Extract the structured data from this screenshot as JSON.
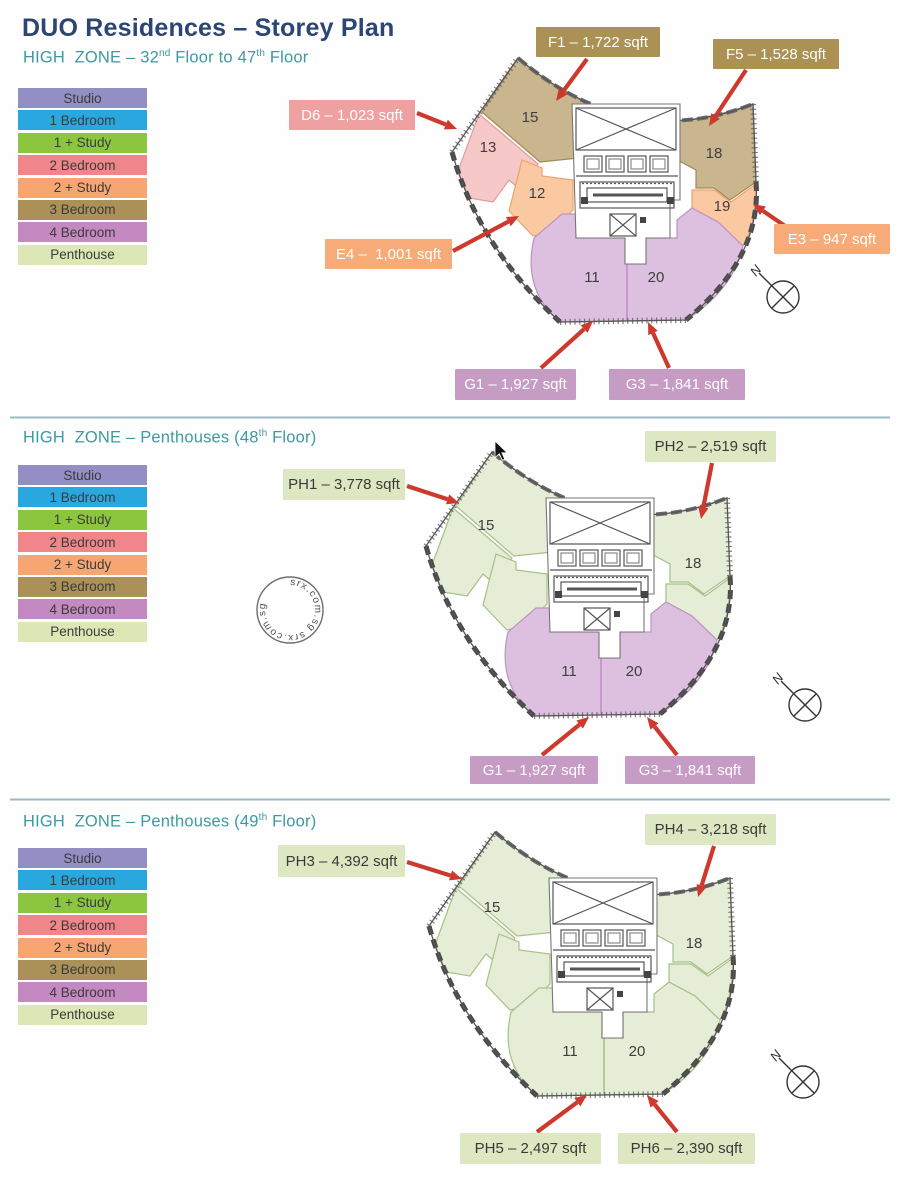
{
  "title": "DUO Residences – Storey Plan",
  "watermark_text": "srx.com.sg",
  "compass_label": "N",
  "legend": {
    "items": [
      {
        "key": "studio",
        "label": "Studio"
      },
      {
        "key": "bed1",
        "label": "1 Bedroom"
      },
      {
        "key": "bed1study",
        "label": "1 + Study"
      },
      {
        "key": "bed2",
        "label": "2 Bedroom"
      },
      {
        "key": "bed2study",
        "label": "2 + Study"
      },
      {
        "key": "bed3",
        "label": "3 Bedroom"
      },
      {
        "key": "bed4",
        "label": "4 Bedroom"
      },
      {
        "key": "penthouse",
        "label": "Penthouse"
      }
    ]
  },
  "colors": {
    "title": "#2c4573",
    "subtitle": "#3d9aa1",
    "arrow": "#ce382d",
    "separator": "#9db9c6",
    "plan_line": "#565656",
    "legend": {
      "studio": "#938fc5",
      "bed1": "#29a8e0",
      "bed1study": "#8cc63f",
      "bed2": "#f0868a",
      "bed2study": "#f8a671",
      "bed3": "#ab9157",
      "bed4": "#c489c0",
      "penthouse": "#dde7b6"
    },
    "region_fill": {
      "bed2": "#f7c8c8",
      "bed2study": "#fac9a2",
      "bed3": "#c9b58e",
      "bed4": "#ddbfdf",
      "penthouse": "#e5edd6"
    },
    "region_stroke": {
      "bed2": "#e39b9b",
      "bed2study": "#eca26e",
      "bed3": "#a18a56",
      "bed4": "#c092c2",
      "penthouse": "#a9bf86"
    },
    "callout": {
      "tan": "#ab9254",
      "pink": "#efa1a1",
      "orange": "#f6ab79",
      "purple": "#c79cc4",
      "green": "#dde8c2"
    },
    "callout_text": {
      "tan": "#ffffff",
      "pink": "#ffffff",
      "orange": "#ffffff",
      "purple": "#ffffff",
      "green": "#3a3a3a"
    }
  },
  "sections": [
    {
      "subtitle": {
        "part1": "HIGH  ZONE – 32",
        "sup1": "nd",
        "part2": " Floor to 47",
        "sup2": "th",
        "part3": " Floor"
      },
      "units": {
        "u15": "15",
        "u13": "13",
        "u12": "12",
        "u18": "18",
        "u19": "19",
        "u11": "11",
        "u20": "20"
      },
      "region_types": {
        "r15": "bed3",
        "r13": "bed2",
        "r12": "bed2study",
        "r18": "bed3",
        "r19": "bed2study",
        "r11_20": "bed4"
      },
      "callouts": [
        {
          "id": "F1",
          "label": "F1 – 1,722 sqft",
          "color": "tan"
        },
        {
          "id": "F5",
          "label": "F5 – 1,528 sqft",
          "color": "tan"
        },
        {
          "id": "D6",
          "label": "D6 – 1,023 sqft",
          "color": "pink"
        },
        {
          "id": "E4",
          "label": "E4 –  1,001 sqft",
          "color": "orange"
        },
        {
          "id": "E3",
          "label": "E3 – 947 sqft",
          "color": "orange"
        },
        {
          "id": "G1",
          "label": "G1 – 1,927 sqft",
          "color": "purple"
        },
        {
          "id": "G3",
          "label": "G3 – 1,841 sqft",
          "color": "purple"
        }
      ]
    },
    {
      "subtitle": {
        "part1": "HIGH  ZONE – Penthouses (48",
        "sup1": "th",
        "part2": " Floor)",
        "sup2": "",
        "part3": ""
      },
      "units": {
        "u15": "15",
        "u18": "18",
        "u11": "11",
        "u20": "20"
      },
      "region_types": {
        "r15": "penthouse",
        "r13": "penthouse",
        "r12": "penthouse",
        "r18": "penthouse",
        "r19": "penthouse",
        "r11_20": "bed4"
      },
      "callouts": [
        {
          "id": "PH1",
          "label": "PH1 – 3,778 sqft",
          "color": "green"
        },
        {
          "id": "PH2",
          "label": "PH2 – 2,519 sqft",
          "color": "green"
        },
        {
          "id": "G1",
          "label": "G1 – 1,927 sqft",
          "color": "purple"
        },
        {
          "id": "G3",
          "label": "G3 – 1,841 sqft",
          "color": "purple"
        }
      ]
    },
    {
      "subtitle": {
        "part1": "HIGH  ZONE – Penthouses (49",
        "sup1": "th",
        "part2": " Floor)",
        "sup2": "",
        "part3": ""
      },
      "units": {
        "u15": "15",
        "u18": "18",
        "u11": "11",
        "u20": "20"
      },
      "region_types": {
        "r15": "penthouse",
        "r13": "penthouse",
        "r12": "penthouse",
        "r18": "penthouse",
        "r19": "penthouse",
        "r11_20": "penthouse"
      },
      "callouts": [
        {
          "id": "PH3",
          "label": "PH3 – 4,392 sqft",
          "color": "green"
        },
        {
          "id": "PH4",
          "label": "PH4 – 3,218 sqft",
          "color": "green"
        },
        {
          "id": "PH5",
          "label": "PH5 – 2,497 sqft",
          "color": "green"
        },
        {
          "id": "PH6",
          "label": "PH6 – 2,390 sqft",
          "color": "green"
        }
      ]
    }
  ]
}
